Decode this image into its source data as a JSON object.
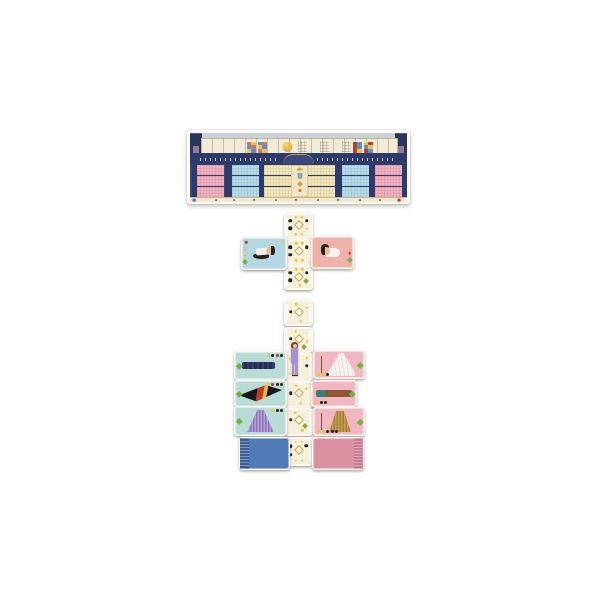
{
  "board": {
    "x": 187,
    "y": 130,
    "w": 223,
    "h": 74,
    "frame_color": "#fbfaf4",
    "facade_color": "#2c3b6a",
    "sky_color": "#cad3da",
    "track": {
      "bg": "#f2ecd7",
      "coin": {
        "x": 81,
        "y": 3,
        "d": 9,
        "color": "#e7b73c"
      },
      "legends": [
        {
          "x": 44,
          "colors": [
            "#d96b7e",
            "#e8c63e",
            "#5b8fc7",
            "#d96b7e",
            "#e8c63e",
            "#5b8fc7"
          ]
        },
        {
          "x": 55,
          "colors": [
            "#5b8fc7",
            "#d96b7e",
            "#e8c63e",
            "#5b8fc7",
            "#d96b7e",
            "#e8c63e"
          ]
        },
        {
          "x": 150,
          "colors": [
            "#c0392b",
            "#5b8fc7",
            "#c0392b",
            "#5b8fc7",
            "#c0392b",
            "#e8c63e"
          ]
        },
        {
          "x": 161,
          "colors": [
            "#e8c63e",
            "#c0392b",
            "#5b8fc7",
            "#e8c63e",
            "#c0392b",
            "#5b8fc7"
          ]
        }
      ],
      "patterns": [
        96,
        118,
        140
      ]
    },
    "rows": [
      35,
      46,
      57
    ],
    "row_h": 10,
    "sections": [
      {
        "name": "pink-grid-left",
        "color": "#efb4c1",
        "line": "#de8fa5",
        "x": 10,
        "w": 27
      },
      {
        "name": "blue-grid-left",
        "color": "#bcdde8",
        "line": "#8fc0d4",
        "x": 45,
        "w": 27
      },
      {
        "name": "cream-grid-left",
        "color": "#f2e9c5",
        "line": "#d9c488",
        "x": 77,
        "w": 27
      },
      {
        "name": "cream-grid-right",
        "color": "#f2e9c5",
        "line": "#d9c488",
        "x": 121,
        "w": 27
      },
      {
        "name": "blue-grid-right",
        "color": "#bcdde8",
        "line": "#8fc0d4",
        "x": 155,
        "w": 27
      },
      {
        "name": "pink-grid-right",
        "color": "#efb4c1",
        "line": "#de8fa5",
        "x": 188,
        "w": 27
      }
    ],
    "center_column": {
      "x": 104,
      "w": 17,
      "icons": [
        "crown",
        "shield",
        "diamond",
        "medal"
      ]
    },
    "bottom_marks": [
      {
        "x": 4,
        "c": "#3a6bb5",
        "s": "square"
      },
      {
        "x": 26,
        "c": "#7a6b45",
        "s": "dot"
      },
      {
        "x": 44,
        "c": "#7a6b45",
        "s": "dot"
      },
      {
        "x": 64,
        "c": "#7a6b45",
        "s": "diamond"
      },
      {
        "x": 86,
        "c": "#7a6b45",
        "s": "dot"
      },
      {
        "x": 106,
        "c": "#7a6b45",
        "s": "diamond"
      },
      {
        "x": 128,
        "c": "#7a6b45",
        "s": "dot"
      },
      {
        "x": 148,
        "c": "#7a6b45",
        "s": "diamond"
      },
      {
        "x": 170,
        "c": "#7a6b45",
        "s": "dot"
      },
      {
        "x": 190,
        "c": "#7a6b45",
        "s": "dot"
      },
      {
        "x": 209,
        "c": "#c0392b",
        "s": "square"
      }
    ]
  },
  "pieces": {
    "figure": {
      "name": "model-standee",
      "x": 288,
      "y": 342,
      "w": 13,
      "h": 35,
      "hair": "#7e3f28",
      "skin": "#e9bd95",
      "outfit": "#a98fd4",
      "shoes": "#3a2e26"
    }
  },
  "cards": [
    {
      "name": "path-card-1",
      "type": "path",
      "x": 284,
      "y": 213,
      "w": 27,
      "h": 24,
      "dots": [
        {
          "t": "black",
          "x": 20,
          "y": 28
        },
        {
          "t": "black",
          "x": 20,
          "y": 60
        },
        {
          "t": "black",
          "x": 80,
          "y": 28
        },
        {
          "t": "yellow",
          "x": 40,
          "y": 14
        },
        {
          "t": "yellow",
          "x": 62,
          "y": 14
        },
        {
          "t": "yellow",
          "x": 40,
          "y": 84
        },
        {
          "t": "yellow",
          "x": 62,
          "y": 84
        },
        {
          "t": "yellow",
          "x": 80,
          "y": 62
        },
        {
          "t": "wdiamond",
          "x": 50,
          "y": 44
        }
      ]
    },
    {
      "name": "path-card-2",
      "type": "path",
      "x": 284,
      "y": 239,
      "w": 27,
      "h": 24,
      "dots": [
        {
          "t": "black",
          "x": 20,
          "y": 30
        },
        {
          "t": "black",
          "x": 20,
          "y": 62
        },
        {
          "t": "black",
          "x": 80,
          "y": 30
        },
        {
          "t": "yellow",
          "x": 42,
          "y": 14
        },
        {
          "t": "yellow",
          "x": 64,
          "y": 14
        },
        {
          "t": "yellow",
          "x": 42,
          "y": 84
        },
        {
          "t": "yellow",
          "x": 64,
          "y": 84
        },
        {
          "t": "wdiamond",
          "x": 50,
          "y": 46
        }
      ]
    },
    {
      "name": "path-card-3",
      "type": "path",
      "x": 284,
      "y": 265,
      "w": 27,
      "h": 23,
      "dots": [
        {
          "t": "black",
          "x": 20,
          "y": 30
        },
        {
          "t": "black",
          "x": 20,
          "y": 62
        },
        {
          "t": "black",
          "x": 80,
          "y": 30
        },
        {
          "t": "yellow",
          "x": 42,
          "y": 14
        },
        {
          "t": "yellow",
          "x": 64,
          "y": 14
        },
        {
          "t": "yellow",
          "x": 55,
          "y": 84
        },
        {
          "t": "gdiamond",
          "x": 78,
          "y": 66
        },
        {
          "t": "wdiamond",
          "x": 50,
          "y": 46
        }
      ]
    },
    {
      "name": "path-card-4",
      "type": "path",
      "x": 284,
      "y": 300,
      "w": 27,
      "h": 24,
      "dots": [
        {
          "t": "black",
          "x": 22,
          "y": 44
        },
        {
          "t": "wdiamond",
          "x": 52,
          "y": 44
        },
        {
          "t": "yellow",
          "x": 42,
          "y": 14
        },
        {
          "t": "yellow",
          "x": 80,
          "y": 28
        },
        {
          "t": "yellow",
          "x": 58,
          "y": 84
        }
      ]
    },
    {
      "name": "path-card-5",
      "type": "path",
      "x": 284,
      "y": 327,
      "w": 27,
      "h": 24,
      "dots": [
        {
          "t": "black",
          "x": 22,
          "y": 44
        },
        {
          "t": "wdiamond",
          "x": 52,
          "y": 44
        },
        {
          "t": "yellow",
          "x": 40,
          "y": 14
        },
        {
          "t": "yellow",
          "x": 80,
          "y": 55
        },
        {
          "t": "gdiamond",
          "x": 72,
          "y": 80
        }
      ]
    },
    {
      "name": "path-card-6",
      "type": "path",
      "x": 284,
      "y": 353,
      "w": 27,
      "h": 26,
      "dots": [
        {
          "t": "black",
          "x": 80,
          "y": 46
        },
        {
          "t": "yellow",
          "x": 18,
          "y": 18
        },
        {
          "t": "yellow",
          "x": 18,
          "y": 76
        },
        {
          "t": "yellow",
          "x": 80,
          "y": 16
        }
      ]
    },
    {
      "name": "path-card-7",
      "type": "path",
      "x": 284,
      "y": 381,
      "w": 27,
      "h": 25,
      "dots": [
        {
          "t": "black",
          "x": 22,
          "y": 44
        },
        {
          "t": "wdiamond",
          "x": 52,
          "y": 44
        },
        {
          "t": "yellow",
          "x": 42,
          "y": 14
        },
        {
          "t": "yellow",
          "x": 78,
          "y": 26
        },
        {
          "t": "yellow",
          "x": 58,
          "y": 84
        }
      ]
    },
    {
      "name": "path-card-8",
      "type": "path",
      "x": 284,
      "y": 408,
      "w": 27,
      "h": 26,
      "dots": [
        {
          "t": "wdiamond",
          "x": 50,
          "y": 42
        },
        {
          "t": "black",
          "x": 22,
          "y": 42
        },
        {
          "t": "gdiamond",
          "x": 74,
          "y": 66
        },
        {
          "t": "yellow",
          "x": 38,
          "y": 14
        },
        {
          "t": "yellow",
          "x": 64,
          "y": 82
        }
      ]
    },
    {
      "name": "path-card-9",
      "type": "path",
      "x": 284,
      "y": 437,
      "w": 27,
      "h": 27,
      "dots": [
        {
          "t": "black",
          "x": 20,
          "y": 30
        },
        {
          "t": "black",
          "x": 20,
          "y": 62
        },
        {
          "t": "black",
          "x": 78,
          "y": 28
        },
        {
          "t": "wdiamond",
          "x": 50,
          "y": 46
        },
        {
          "t": "yellow",
          "x": 40,
          "y": 14
        },
        {
          "t": "yellow",
          "x": 62,
          "y": 14
        },
        {
          "t": "yellow",
          "x": 40,
          "y": 84
        },
        {
          "t": "yellow",
          "x": 62,
          "y": 84
        }
      ]
    },
    {
      "name": "character-card-left",
      "type": "character",
      "variant": "left",
      "x": 241,
      "y": 237,
      "w": 44,
      "h": 31,
      "bg": "#b4d8e1",
      "icons": [
        {
          "t": "red",
          "x": 10,
          "y": 14
        },
        {
          "t": "yellow",
          "x": 7,
          "y": 38
        },
        {
          "t": "yellow",
          "x": 7,
          "y": 58
        },
        {
          "t": "gdiamond",
          "x": 7,
          "y": 78
        },
        {
          "t": "yellow",
          "x": 91,
          "y": 12
        }
      ]
    },
    {
      "name": "character-card-right",
      "type": "character",
      "variant": "right",
      "x": 311,
      "y": 236,
      "w": 41,
      "h": 31,
      "bg": "#eeb1ab",
      "icons": [
        {
          "t": "yellow",
          "x": 92,
          "y": 30
        },
        {
          "t": "red",
          "x": 92,
          "y": 52
        },
        {
          "t": "gdiamond",
          "x": 92,
          "y": 74
        },
        {
          "t": "yellow",
          "x": 7,
          "y": 84
        }
      ]
    },
    {
      "name": "dress-card-navy-column",
      "type": "dress",
      "dress": "navy-column",
      "x": 234,
      "y": 351,
      "w": 51,
      "h": 27,
      "bg": "#b9dcd7",
      "corner": "tr",
      "corner_dots": [
        "#e8c63e",
        "#26221f",
        "#b93a2c",
        "#26221f"
      ]
    },
    {
      "name": "dress-card-black-red-gown",
      "type": "dress",
      "dress": "black-red-gown",
      "x": 234,
      "y": 380,
      "w": 51,
      "h": 25,
      "bg": "#b9dcd7",
      "corner": "tr",
      "corner_dots": [
        "#e8c63e",
        "#b93a2c",
        "#26221f",
        "#26221f"
      ]
    },
    {
      "name": "dress-card-purple-fringe",
      "type": "dress",
      "dress": "purple-fringe",
      "x": 234,
      "y": 406,
      "w": 51,
      "h": 28,
      "bg": "#b9dcd7",
      "corner": "tr",
      "corner_dots": [
        "#e8c63e",
        "#26221f",
        "#26221f"
      ]
    },
    {
      "name": "dress-card-white-gown",
      "type": "dress",
      "dress": "white-gown",
      "x": 313,
      "y": 350,
      "w": 50,
      "h": 27,
      "bg": "#f1b8c2",
      "corner": "bl",
      "corner_dots": [
        "#e8c63e",
        "#e8c63e",
        "#26221f"
      ]
    },
    {
      "name": "dress-card-brown-teal",
      "type": "dress",
      "dress": "brown-teal",
      "x": 311,
      "y": 380,
      "w": 44,
      "h": 25,
      "bg": "#f1b8c2",
      "corner": "bl",
      "corner_dots": [
        "#e8c63e",
        "#26221f",
        "#26221f"
      ]
    },
    {
      "name": "dress-card-gold-fringe",
      "type": "dress",
      "dress": "gold-fringe",
      "x": 313,
      "y": 407,
      "w": 50,
      "h": 27,
      "bg": "#f1b8c2",
      "corner": "bl",
      "corner_dots": [
        "#e8c63e",
        "#e8c63e",
        "#26221f",
        "#26221f",
        "#26221f"
      ]
    },
    {
      "name": "deck-card-blue",
      "type": "deck",
      "variant": "blue",
      "x": 239,
      "y": 437,
      "w": 49,
      "h": 31,
      "bg": "#4e7bb5"
    },
    {
      "name": "deck-card-pink",
      "type": "deck",
      "variant": "pink",
      "x": 312,
      "y": 437,
      "w": 50,
      "h": 31,
      "bg": "#dc91a3"
    }
  ]
}
